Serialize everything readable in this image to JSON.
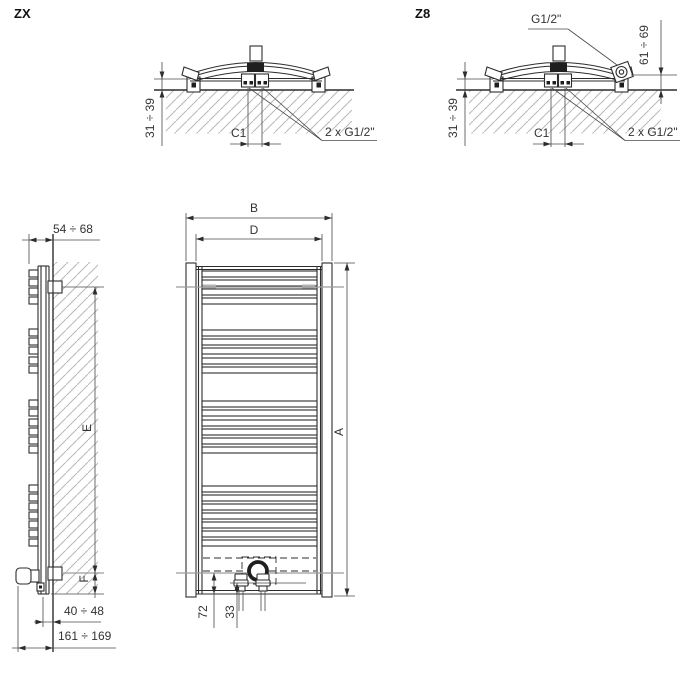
{
  "drawing": {
    "zx": {
      "label": "ZX",
      "wall_offset": "31 ÷ 39",
      "center_distance": "C1",
      "connections": "2 x G1/2\""
    },
    "z8": {
      "label": "Z8",
      "top_connection": "G1/2\"",
      "front_offset": "61 ÷ 69",
      "wall_offset": "31 ÷ 39",
      "center_distance": "C1",
      "connections": "2 x G1/2\""
    },
    "side": {
      "depth": "54 ÷ 68",
      "mount_span": "E",
      "bottom_offset": "F",
      "wall_clearance": "40 ÷ 48",
      "total_depth": "161 ÷ 169"
    },
    "front": {
      "overall_width": "B",
      "connection_width": "D",
      "overall_height": "A",
      "element_height": "72",
      "valve_height": "33"
    }
  },
  "colors": {
    "line": "#2d2d2d",
    "hatch": "#b8b8b8",
    "bracket_line": "#9c9c9c"
  }
}
